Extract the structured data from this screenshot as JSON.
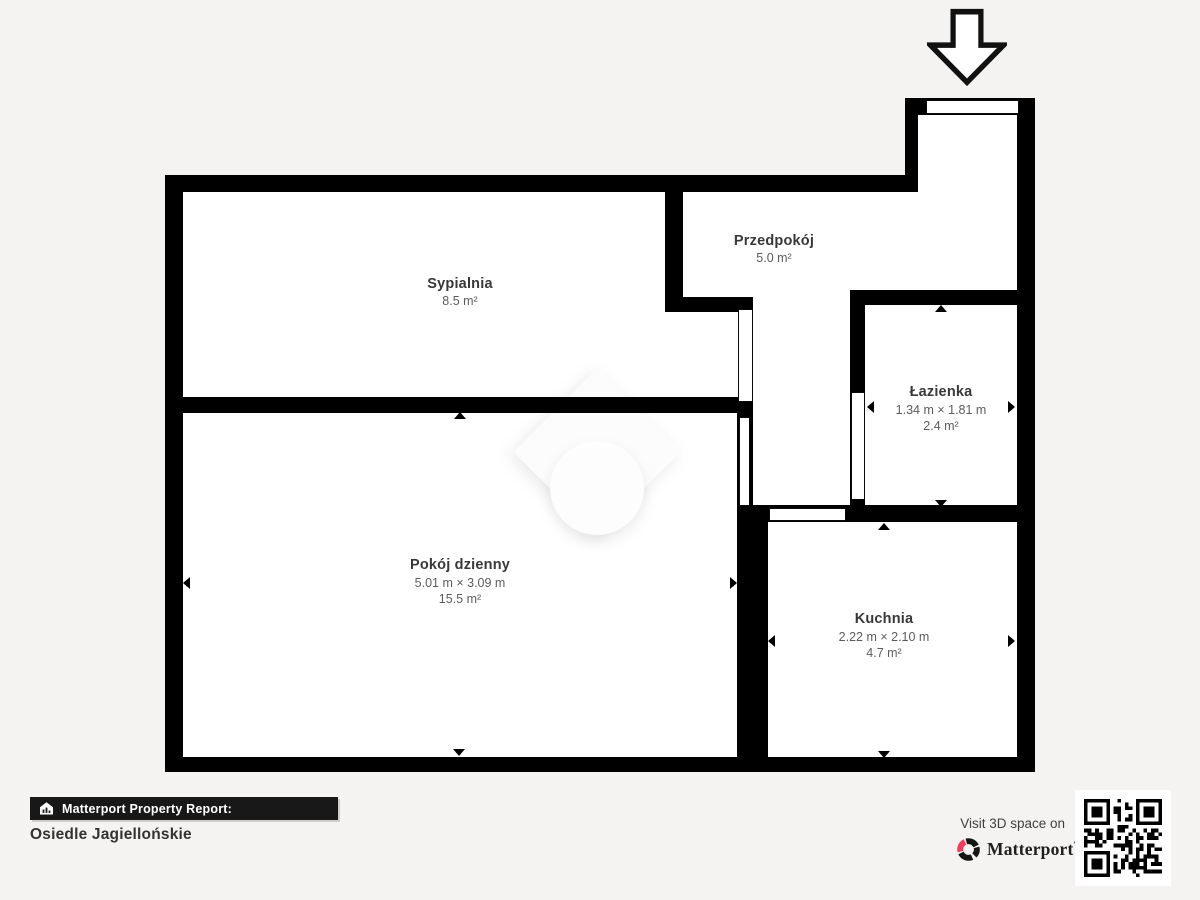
{
  "page": {
    "background_color": "#f4f3f1",
    "wall_color": "#000000",
    "floor_color": "#ffffff"
  },
  "floorplan": {
    "rooms": [
      {
        "id": "sypialnia",
        "name": "Sypialnia",
        "dims": "",
        "area": "8.5 m²"
      },
      {
        "id": "przedpokoj",
        "name": "Przedpokój",
        "dims": "",
        "area": "5.0 m²"
      },
      {
        "id": "lazienka",
        "name": "Łazienka",
        "dims": "1.34 m × 1.81 m",
        "area": "2.4 m²"
      },
      {
        "id": "pokoj-dzienny",
        "name": "Pokój dzienny",
        "dims": "5.01 m × 3.09 m",
        "area": "15.5 m²"
      },
      {
        "id": "kuchnia",
        "name": "Kuchnia",
        "dims": "2.22 m × 2.10 m",
        "area": "4.7 m²"
      }
    ],
    "entrance_arrow_direction": "down"
  },
  "footer": {
    "report_label": "Matterport Property Report:",
    "property_name": "Osiedle Jagiellońskie",
    "visit_text": "Visit 3D space on",
    "brand_name": "Matterport",
    "brand_trademark": "'",
    "brand_pink": "#f13a5e"
  }
}
